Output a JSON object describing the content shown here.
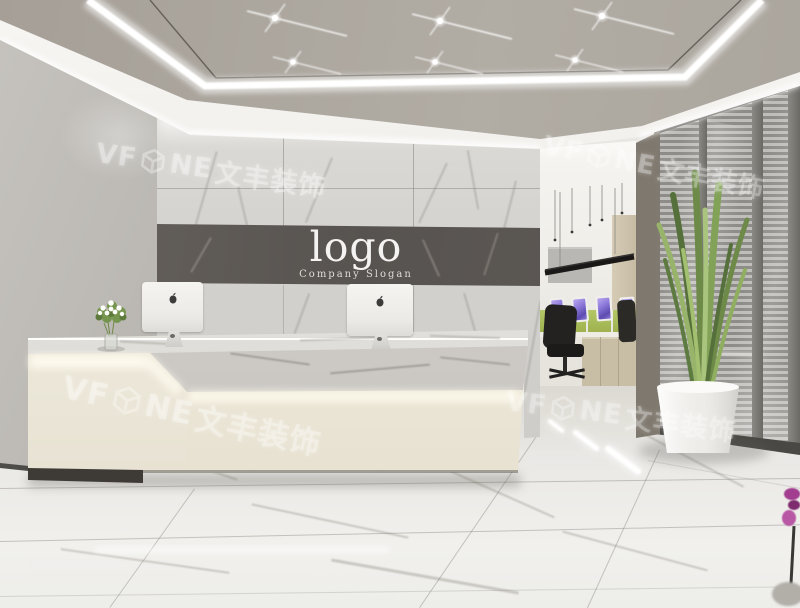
{
  "scene": {
    "logo_wall": {
      "logo_text": "logo",
      "slogan_text": "Company Slogan"
    },
    "watermark": {
      "prefix": "VF",
      "suffix": "NE",
      "chinese": "文丰装饰"
    },
    "counts": {
      "ceiling_spotlights": 6,
      "office_monitors": 4,
      "reception_computers": 2,
      "watermarks": 4
    },
    "palette": {
      "ceiling_panel": "#aaa59d",
      "led_white": "#ffffff",
      "wall_gray": "#b0ada8",
      "marble_light": "#d8d6d2",
      "logo_band": "#5a5551",
      "desk_cream": "#f2eddd",
      "floor": "#eae9e6",
      "glass_gray": "#a09f9b",
      "frame_dark": "#504e4a",
      "partition_green": "#a8bc55",
      "screen_purple": "#8a7bd8",
      "chair_black": "#242220",
      "plant_green": "#7a9752",
      "flower_magenta": "#a23d8f"
    }
  }
}
